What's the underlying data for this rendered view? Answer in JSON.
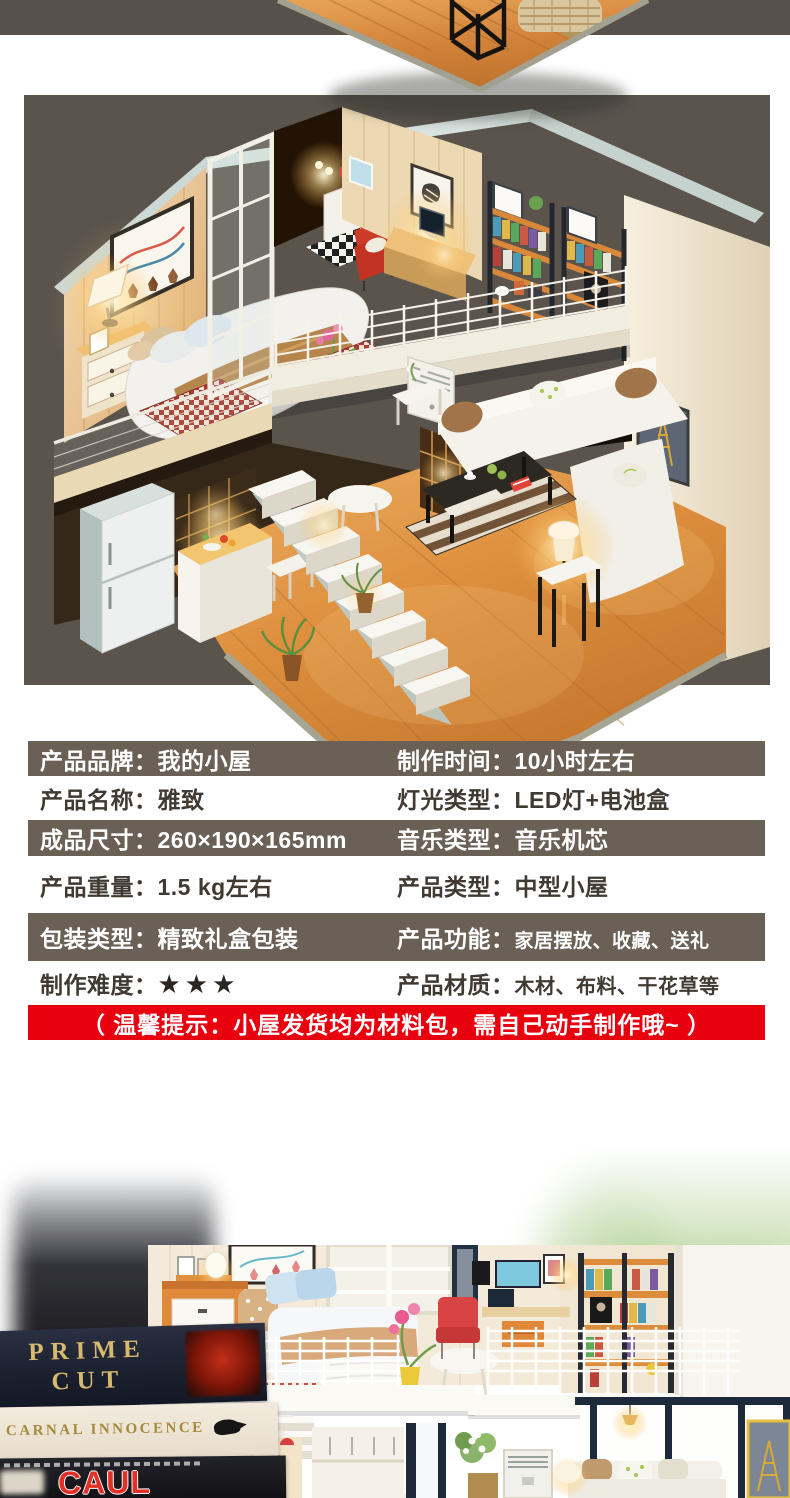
{
  "colors": {
    "top_band_bg": "#56514a",
    "main_photo_bg": "#5a544d",
    "table_dark_row_bg": "#6b6056",
    "table_dark_row_text": "#ffffff",
    "table_light_row_text": "#403a33",
    "star_color": "#2b2622",
    "notice_bg": "#e8000f",
    "notice_text": "#ffffff"
  },
  "spec_table": {
    "rows": [
      {
        "left_label": "产品品牌：",
        "left_value": "我的小屋",
        "right_label": "制作时间：",
        "right_value": "10小时左右"
      },
      {
        "left_label": "产品名称：",
        "left_value": "雅致",
        "right_label": "灯光类型：",
        "right_value": "LED灯+电池盒"
      },
      {
        "left_label": "成品尺寸：",
        "left_value": "260×190×165mm",
        "right_label": "音乐类型：",
        "right_value": "音乐机芯"
      },
      {
        "left_label": "产品重量：",
        "left_value": "1.5 kg左右",
        "right_label": "产品类型：",
        "right_value": "中型小屋"
      },
      {
        "left_label": "包装类型：",
        "left_value": "精致礼盒包装",
        "right_label": "产品功能：",
        "right_value": "家居摆放、收藏、送礼"
      },
      {
        "left_label": "制作难度：",
        "left_value": "★★★",
        "right_label": "产品材质：",
        "right_value": "木材、布料、干花草等"
      }
    ]
  },
  "notice": {
    "text": "（ 温馨提示：小屋发货均为材料包，需自己动手制作哦~ ）"
  },
  "photos": {
    "bottom": {
      "books": [
        "PRIME CUT",
        "CARNAL INNOCENCE",
        "CAUL"
      ]
    }
  }
}
